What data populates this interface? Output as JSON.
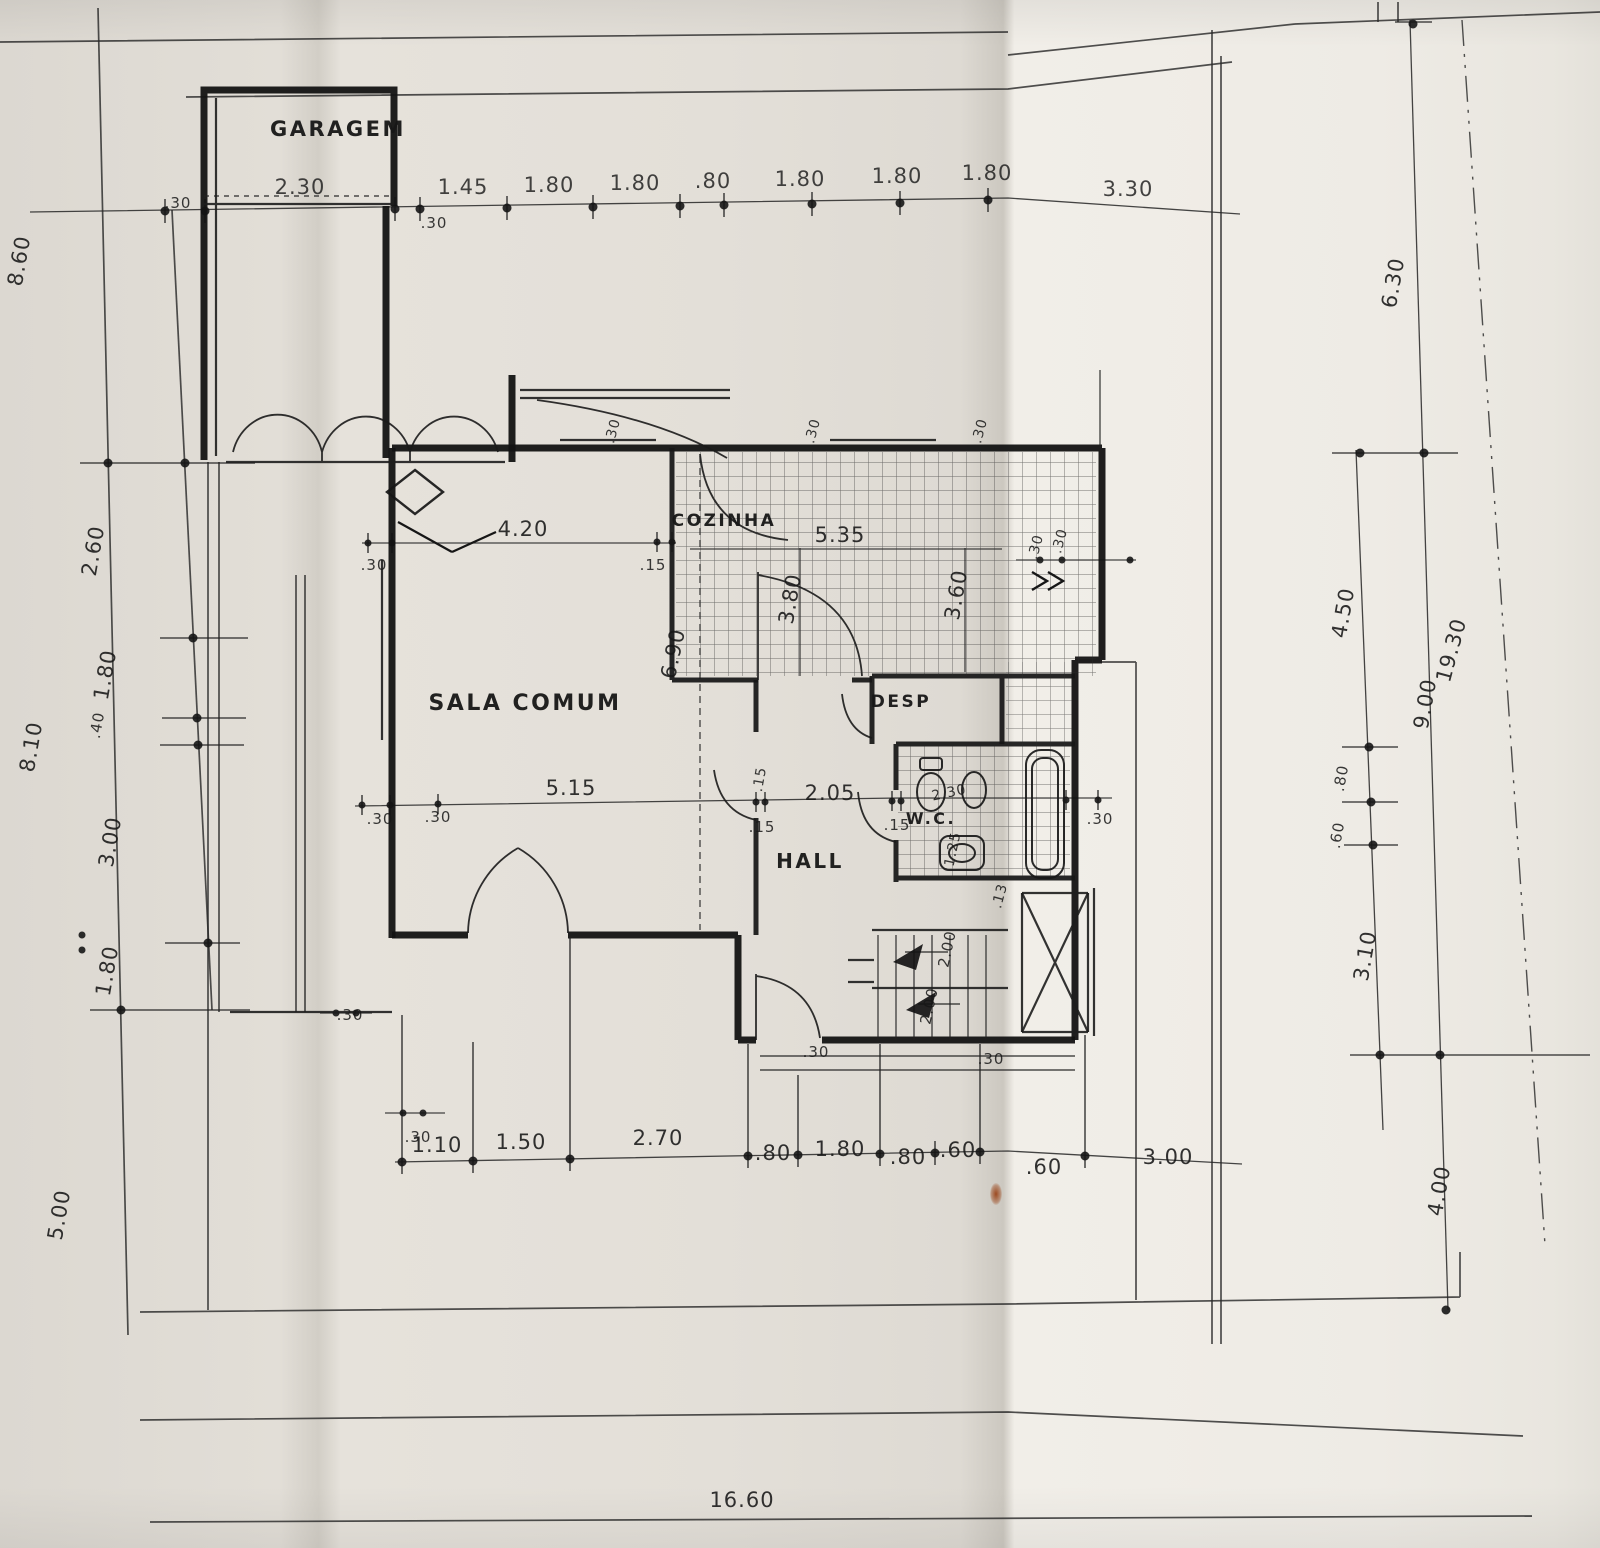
{
  "paper": {
    "background": "#e3dfd8",
    "bright_fold": "#f1eee8",
    "ink": "#1c1c1c",
    "stain": "#9c4a20"
  },
  "rooms": {
    "garagem": "GARAGEM",
    "sala": "SALA COMUM",
    "cozinha": "COZINHA",
    "desp": "DESP",
    "wc": "W.C.",
    "hall": "HALL"
  },
  "dims": {
    "top": [
      ".30",
      "2.30",
      ".30",
      "1.45",
      "1.80",
      "1.80",
      ".80",
      "1.80",
      "1.80",
      "1.80",
      "3.30"
    ],
    "left": [
      "8.60",
      "2.60",
      "1.80",
      ".40",
      "8.10",
      "3.00",
      "1.80",
      "5.00"
    ],
    "right": [
      "6.30",
      "4.50",
      ".80",
      ".60",
      "3.10",
      "9.00",
      "4.00",
      "19.30"
    ],
    "bottom": [
      "1.10",
      "1.50",
      "2.70",
      ".80",
      "1.80",
      ".80",
      ".60",
      ".60",
      "3.00"
    ],
    "bottom_total": "16.60",
    "interior": {
      "sala_w": "4.20",
      "sala_wall": ".30",
      "sala_k_wall": ".15",
      "sala_h": "6.90",
      "kitchen_w": "5.35",
      "kitchen_hl": "3.80",
      "kitchen_hr": "3.60",
      "top_ticks": [
        ".30",
        ".30",
        ".30"
      ],
      "wing_ticks": [
        ".30",
        ".30"
      ],
      "mid": [
        ".30",
        ".30",
        "5.15",
        ".15",
        "2.05",
        ".15",
        ".30"
      ],
      "wc": [
        "2.30",
        "1.25"
      ],
      "desp_tick": ".15",
      "stairs": [
        "2.00",
        "2.00",
        ".13"
      ],
      "bottom_ticks": [
        ".30",
        ".30",
        ".30",
        ".30"
      ]
    }
  }
}
